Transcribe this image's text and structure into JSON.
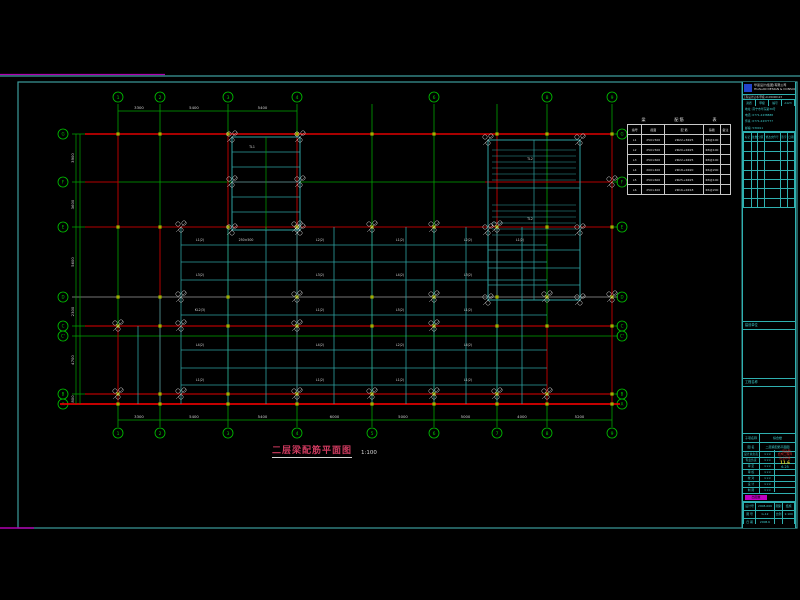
{
  "app": {
    "name": "CAD structural drawing viewer",
    "background": "#000000"
  },
  "frame": {
    "border_color": "#3d9c9c",
    "magenta_mark_color": "#b000b0",
    "top_line_y": 76,
    "rect": [
      18,
      82,
      797,
      528
    ]
  },
  "drawing_title": {
    "text": "二层梁配筋平面图",
    "scale": "1:100",
    "color": "#cf3a5f"
  },
  "schedule": {
    "title_parts": [
      "梁",
      "配 筋",
      "表"
    ],
    "headers": [
      "编号",
      "截面",
      "配  筋",
      "箍筋",
      "备注"
    ],
    "rows": [
      [
        "L1",
        "250×500",
        "2Φ22+3Φ25",
        "Φ8@100",
        ""
      ],
      [
        "L2",
        "250×500",
        "2Φ20+2Φ25",
        "Φ8@100",
        ""
      ],
      [
        "L3",
        "250×600",
        "2Φ22+4Φ25",
        "Φ8@100",
        ""
      ],
      [
        "L4",
        "200×400",
        "2Φ18+2Φ20",
        "Φ6@200",
        ""
      ],
      [
        "L5",
        "250×600",
        "2Φ25+4Φ25",
        "Φ8@100",
        ""
      ],
      [
        "L6",
        "250×400",
        "2Φ16+2Φ18",
        "Φ6@200",
        ""
      ]
    ]
  },
  "titleblock": {
    "company": "华蓝设计(集团)有限公司",
    "company_en": "HUALAN DESIGN & CONSULTING GROUP",
    "cert": "工程设计证书 甲级 A145000123",
    "cells": [
      "资质",
      "甲级",
      "编号",
      "A123"
    ],
    "address_lines": [
      "地址: 南宁市华东路39号",
      "电话: 0771-2438888",
      "传真: 0771-2437777",
      "邮编: 530011"
    ],
    "rev_headers": [
      "标记",
      "处数",
      "分区",
      "修改文件号",
      "签字",
      "日期"
    ],
    "rev_empty_rows": 7,
    "stamp_box_label": "",
    "owner_label": "建设单位",
    "project_label": "工程名称",
    "sub_rows": [
      [
        "子项名称",
        "综合楼"
      ],
      [
        "图    名",
        "二层梁配筋平面图"
      ]
    ],
    "name_rows": [
      [
        "设计总负责",
        "×××"
      ],
      [
        "专业负责",
        "×××"
      ],
      [
        "审  定",
        "×××"
      ],
      [
        "审  核",
        "×××"
      ],
      [
        "校  对",
        "×××"
      ],
      [
        "设  计",
        "×××"
      ],
      [
        "制  图",
        "×××"
      ]
    ],
    "stamp_red_lines": [
      "一级注册",
      "结构工程师",
      "执业印章"
    ],
    "stamp_yellow": "11.6",
    "stamp_cyan": "6.25",
    "mag_cell_text": "出图章",
    "bottom_rows": [
      [
        "设计号",
        "2008-069",
        "图别",
        "结施"
      ],
      [
        "图  号",
        "G-12",
        "比例",
        "1:100"
      ],
      [
        "日  期",
        "2008.6",
        "",
        ""
      ]
    ]
  },
  "plan": {
    "colors": {
      "grid_green": "#00a400",
      "bubble_green": "#00c400",
      "red_wall": "#b40000",
      "red_bright": "#e00000",
      "beam_cyan": "#2ea0a0",
      "annot_white": "#d4d4d4",
      "axis_gray": "#9a9a9a",
      "column_olive": "#a0ae00"
    },
    "v_axes": [
      {
        "x": 118,
        "label": "1",
        "top": true,
        "bottom": true
      },
      {
        "x": 160,
        "label": "2",
        "top": true,
        "bottom": true
      },
      {
        "x": 228,
        "label": "3",
        "top": true,
        "bottom": true
      },
      {
        "x": 297,
        "label": "4",
        "top": true,
        "bottom": true
      },
      {
        "x": 372,
        "label": "5",
        "top": false,
        "bottom": true
      },
      {
        "x": 434,
        "label": "6",
        "top": true,
        "bottom": true
      },
      {
        "x": 497,
        "label": "7",
        "top": false,
        "bottom": true
      },
      {
        "x": 547,
        "label": "8",
        "top": true,
        "bottom": true
      },
      {
        "x": 612,
        "label": "9",
        "top": true,
        "bottom": true
      }
    ],
    "h_axes": [
      {
        "y": 134,
        "label": "G"
      },
      {
        "y": 182,
        "label": "F"
      },
      {
        "y": 227,
        "label": "E"
      },
      {
        "y": 297,
        "label": "D",
        "gray": true
      },
      {
        "y": 326,
        "label": "C"
      },
      {
        "y": 336,
        "label": "C'"
      },
      {
        "y": 394,
        "label": "B"
      },
      {
        "y": 404,
        "label": "A"
      }
    ],
    "red_h": [
      [
        85,
        134,
        612,
        1.4
      ],
      [
        85,
        182,
        118,
        1
      ],
      [
        485,
        182,
        612,
        1
      ],
      [
        232,
        182,
        300,
        1
      ],
      [
        85,
        227,
        612,
        1
      ],
      [
        85,
        326,
        612,
        1.2
      ],
      [
        85,
        394,
        612,
        1.2
      ],
      [
        60,
        404,
        620,
        1.8
      ]
    ],
    "red_v": [
      [
        118,
        134,
        227
      ],
      [
        118,
        326,
        404
      ],
      [
        160,
        227,
        404
      ],
      [
        228,
        134,
        227
      ],
      [
        297,
        134,
        404
      ],
      [
        497,
        134,
        297
      ],
      [
        547,
        326,
        404
      ],
      [
        612,
        134,
        404
      ]
    ],
    "beams_h_y": [
      245,
      262,
      280,
      315,
      350,
      368,
      385
    ],
    "beams_h_x": [
      181,
      547
    ],
    "beams_v_x": [
      181,
      228,
      266,
      297,
      334,
      372,
      406,
      434,
      466,
      497,
      522
    ],
    "beams_v_y": [
      227,
      404
    ],
    "extra_beams_v": [
      [
        160,
        297,
        404
      ],
      [
        138,
        326,
        404
      ]
    ],
    "stair_mid": {
      "x": 232,
      "y": 137,
      "w": 68,
      "h": 93,
      "treads_y": [
        152,
        167,
        182,
        197,
        212
      ]
    },
    "stair_right": {
      "x": 488,
      "y": 140,
      "w": 92,
      "h": 160,
      "treads1_y": [
        150,
        156,
        162,
        168,
        174,
        180
      ],
      "landing_y": 188,
      "treads2_y": [
        205,
        211,
        217,
        223,
        229,
        235
      ],
      "beams_y": [
        250,
        268,
        285
      ],
      "mid_x": 534
    },
    "column_xs": [
      118,
      160,
      228,
      297,
      372,
      434,
      497,
      547,
      612
    ],
    "column_ys": [
      134,
      227,
      297,
      326,
      394,
      404
    ],
    "clusters": [
      [
        232,
        137
      ],
      [
        300,
        137
      ],
      [
        232,
        182
      ],
      [
        300,
        182
      ],
      [
        232,
        230
      ],
      [
        300,
        230
      ],
      [
        181,
        227
      ],
      [
        297,
        227
      ],
      [
        372,
        227
      ],
      [
        434,
        227
      ],
      [
        497,
        227
      ],
      [
        181,
        297
      ],
      [
        297,
        297
      ],
      [
        434,
        297
      ],
      [
        547,
        297
      ],
      [
        181,
        326
      ],
      [
        297,
        326
      ],
      [
        434,
        326
      ],
      [
        181,
        394
      ],
      [
        297,
        394
      ],
      [
        372,
        394
      ],
      [
        434,
        394
      ],
      [
        497,
        394
      ],
      [
        547,
        394
      ],
      [
        488,
        140
      ],
      [
        580,
        140
      ],
      [
        488,
        230
      ],
      [
        580,
        230
      ],
      [
        488,
        300
      ],
      [
        580,
        300
      ],
      [
        612,
        182
      ],
      [
        612,
        297
      ],
      [
        118,
        326
      ],
      [
        118,
        394
      ]
    ],
    "beam_tags": [
      [
        200,
        241,
        "L1(2)"
      ],
      [
        246,
        241,
        "250×500"
      ],
      [
        320,
        241,
        "L2(2)"
      ],
      [
        400,
        241,
        "L1(2)"
      ],
      [
        468,
        241,
        "L2(2)"
      ],
      [
        520,
        241,
        "L1(2)"
      ],
      [
        200,
        276,
        "L3(2)"
      ],
      [
        320,
        276,
        "L3(2)"
      ],
      [
        400,
        276,
        "L4(2)"
      ],
      [
        468,
        276,
        "L3(2)"
      ],
      [
        200,
        311,
        "KL2(3)"
      ],
      [
        320,
        311,
        "L1(2)"
      ],
      [
        400,
        311,
        "L5(2)"
      ],
      [
        468,
        311,
        "L1(2)"
      ],
      [
        200,
        346,
        "L4(2)"
      ],
      [
        320,
        346,
        "L4(2)"
      ],
      [
        400,
        346,
        "L2(2)"
      ],
      [
        468,
        346,
        "L4(2)"
      ],
      [
        200,
        381,
        "L1(2)"
      ],
      [
        320,
        381,
        "L1(2)"
      ],
      [
        400,
        381,
        "L1(2)"
      ],
      [
        468,
        381,
        "L1(2)"
      ],
      [
        252,
        148,
        "TL1"
      ],
      [
        530,
        160,
        "TL2"
      ],
      [
        530,
        220,
        "TL2"
      ]
    ],
    "dims_top": {
      "y": 111,
      "segs": [
        [
          118,
          160,
          "3300"
        ],
        [
          160,
          228,
          "5400"
        ],
        [
          228,
          297,
          "5400"
        ]
      ]
    },
    "dims_bottom": {
      "y": 420,
      "segs": [
        [
          118,
          160,
          "3300"
        ],
        [
          160,
          228,
          "5400"
        ],
        [
          228,
          297,
          "5400"
        ],
        [
          297,
          372,
          "6000"
        ],
        [
          372,
          434,
          "5000"
        ],
        [
          434,
          497,
          "5000"
        ],
        [
          497,
          547,
          "4000"
        ],
        [
          547,
          612,
          "5200"
        ]
      ]
    },
    "dims_left": {
      "x": 76,
      "segs": [
        [
          134,
          182,
          "3900"
        ],
        [
          182,
          227,
          "3600"
        ],
        [
          227,
          297,
          "5600"
        ],
        [
          297,
          326,
          "2300"
        ],
        [
          326,
          394,
          "4700"
        ],
        [
          394,
          404,
          "800"
        ]
      ]
    }
  }
}
